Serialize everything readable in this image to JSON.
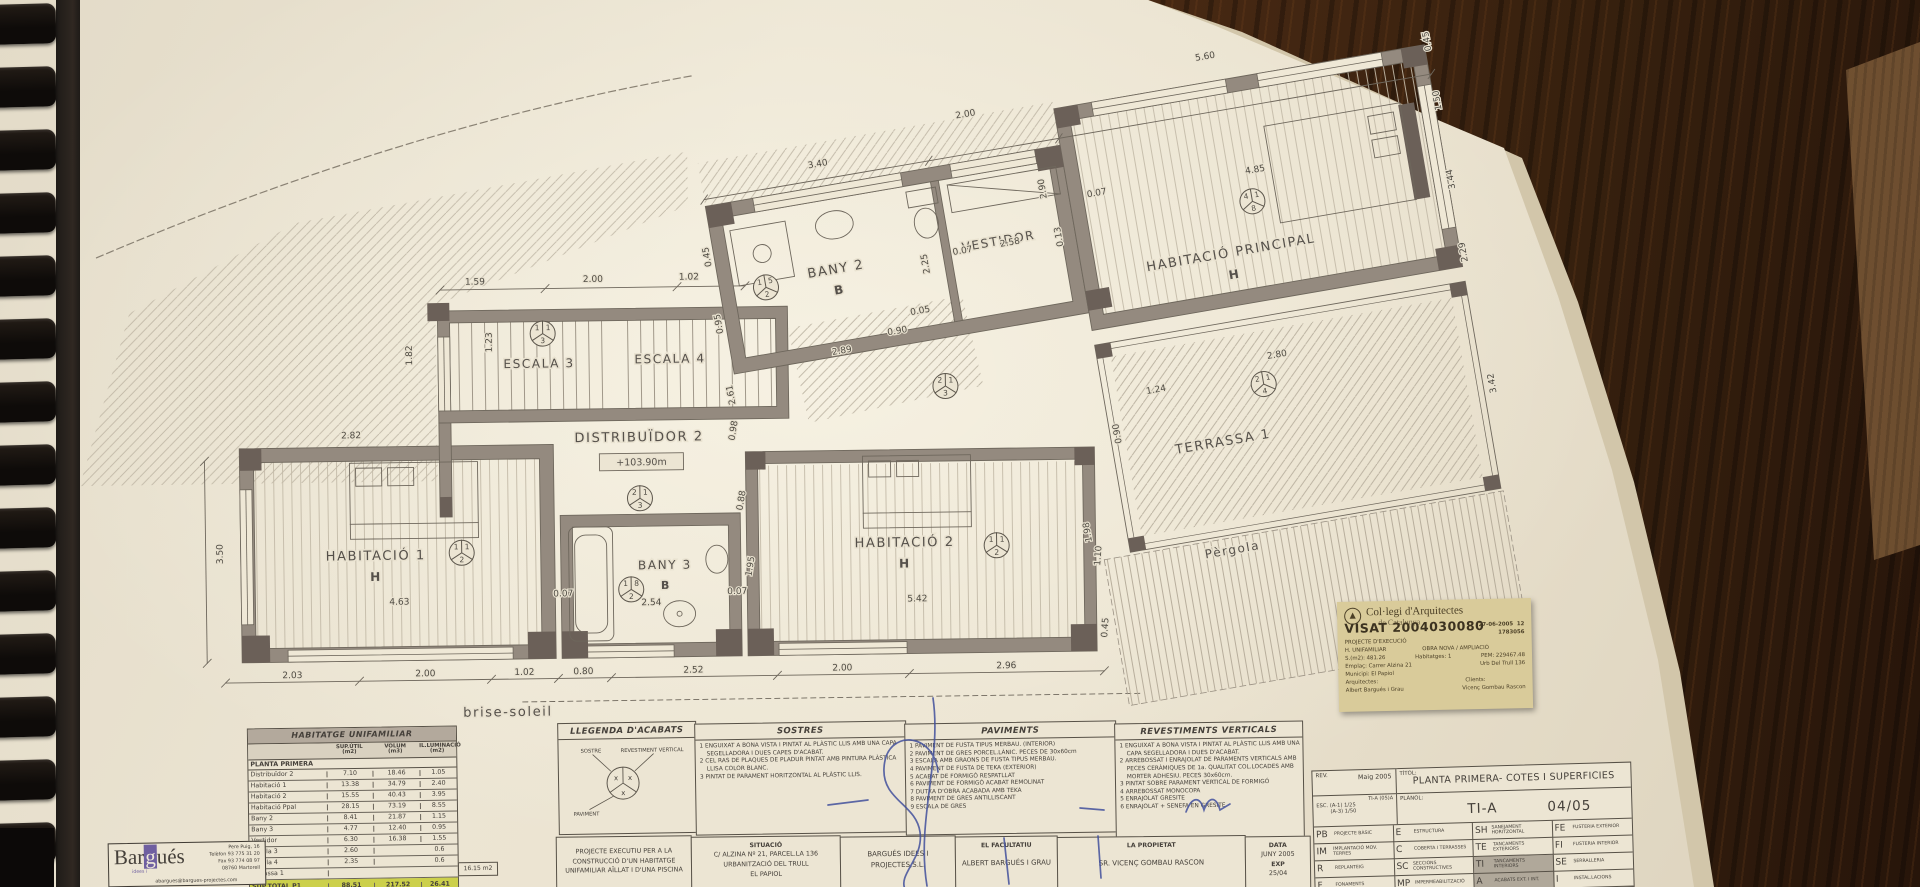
{
  "plan": {
    "labels": [
      [
        "HABITACIÓ 1",
        375,
        556,
        13,
        "s",
        0
      ],
      [
        "H",
        375,
        577,
        12,
        "s",
        1
      ],
      [
        "BANY 3",
        664,
        569,
        12,
        "s",
        0
      ],
      [
        "B",
        664,
        589,
        11,
        "s",
        1
      ],
      [
        "HABITACIÓ 2",
        904,
        550,
        13,
        "s",
        0
      ],
      [
        "H",
        904,
        571,
        12,
        "s",
        1
      ],
      [
        "ESCALA 3",
        541,
        366,
        12,
        "s",
        0
      ],
      [
        "ESCALA 4",
        672,
        363,
        12,
        "s",
        0
      ],
      [
        "DISTRIBUÏDOR 2",
        640,
        441,
        13,
        "s",
        0
      ],
      [
        "+103.90m",
        642,
        465,
        9.5,
        "s",
        0
      ],
      [
        "brise-soleil",
        505,
        714,
        13,
        "s",
        0
      ],
      [
        "BANY 2",
        870,
        300,
        13,
        "u",
        0
      ],
      [
        "B",
        870,
        321,
        12,
        "u",
        1
      ],
      [
        "VESTIDOR",
        1035,
        300,
        12,
        "u",
        0
      ],
      [
        "HABITACIÓ PRINCIPAL",
        1262,
        351,
        13,
        "u",
        0
      ],
      [
        "H",
        1262,
        373,
        12,
        "u",
        1
      ],
      [
        "TERRASSA 1",
        1222,
        536,
        13,
        "u",
        0
      ],
      [
        "Pèrgola",
        1213,
        644,
        12,
        "u",
        0
      ]
    ],
    "dims": [
      [
        "2.03",
        290,
        673,
        0,
        "s"
      ],
      [
        "2.00",
        423,
        673,
        0,
        "s"
      ],
      [
        "1.02",
        522,
        673,
        0,
        "s"
      ],
      [
        "0.80",
        581,
        673,
        0,
        "s"
      ],
      [
        "2.52",
        691,
        673,
        0,
        "s"
      ],
      [
        "2.00",
        840,
        673,
        0,
        "s"
      ],
      [
        "2.96",
        1004,
        673,
        0,
        "s"
      ],
      [
        "4.63",
        398,
        601,
        0,
        "s"
      ],
      [
        "0.07",
        562,
        595,
        0,
        "s"
      ],
      [
        "2.54",
        650,
        605,
        0,
        "s"
      ],
      [
        "0.07",
        736,
        595,
        0,
        "s"
      ],
      [
        "5.42",
        916,
        605,
        0,
        "s"
      ],
      [
        "3.50",
        222,
        548,
        -90,
        "s"
      ],
      [
        "2.82",
        352,
        434,
        0,
        "s"
      ],
      [
        "1.82",
        414,
        352,
        -90,
        "s"
      ],
      [
        "1.23",
        494,
        340,
        -90,
        "s"
      ],
      [
        "1.59",
        478,
        282,
        0,
        "s"
      ],
      [
        "2.00",
        596,
        281,
        0,
        "s"
      ],
      [
        "1.02",
        692,
        280,
        0,
        "s"
      ],
      [
        "0.98",
        737,
        432,
        -80,
        "s"
      ],
      [
        "0.88",
        744,
        502,
        -80,
        "s"
      ],
      [
        "1.95",
        752,
        568,
        -80,
        "s"
      ],
      [
        "1.10",
        1100,
        562,
        -85,
        "s"
      ],
      [
        "0.45",
        1106,
        634,
        -85,
        "s"
      ],
      [
        "3.40",
        870,
        192,
        0,
        "u"
      ],
      [
        "2.00",
        1024,
        168,
        0,
        "u"
      ],
      [
        "5.60",
        1270,
        152,
        0,
        "u"
      ],
      [
        "0.45",
        748,
        262,
        -90,
        "u"
      ],
      [
        "0.95",
        748,
        330,
        -90,
        "u"
      ],
      [
        "2.61",
        748,
        402,
        -90,
        "u"
      ],
      [
        "2.89",
        862,
        380,
        0,
        "u"
      ],
      [
        "0.90",
        920,
        370,
        0,
        "u"
      ],
      [
        "0.05",
        946,
        354,
        0,
        "u"
      ],
      [
        "2.25",
        962,
        306,
        -90,
        "u"
      ],
      [
        "0.07",
        998,
        302,
        0,
        "u"
      ],
      [
        "2.58",
        1046,
        302,
        0,
        "u"
      ],
      [
        "0.13",
        1098,
        302,
        -90,
        "u"
      ],
      [
        "2.90",
        1090,
        252,
        -90,
        "u"
      ],
      [
        "4.85",
        1300,
        272,
        0,
        "u"
      ],
      [
        "0.07",
        1140,
        268,
        0,
        "u"
      ],
      [
        "0.45",
        1494,
        172,
        -90,
        "u"
      ],
      [
        "1.50",
        1494,
        232,
        -90,
        "u"
      ],
      [
        "3.44",
        1494,
        312,
        -90,
        "u"
      ],
      [
        "2.29",
        1494,
        386,
        -90,
        "u"
      ],
      [
        "2.80",
        1290,
        458,
        0,
        "u"
      ],
      [
        "1.24",
        1165,
        472,
        0,
        "u"
      ],
      [
        "0.90",
        1122,
        506,
        -90,
        "u"
      ],
      [
        "1.98",
        1076,
        598,
        -90,
        "u"
      ],
      [
        "3.42",
        1500,
        520,
        -90,
        "u"
      ]
    ],
    "circles": [
      [
        545,
        332,
        "1",
        "1",
        "3",
        "s"
      ],
      [
        630,
        589,
        "1",
        "8",
        "2",
        "s"
      ],
      [
        996,
        550,
        "1",
        "1",
        "2",
        "s"
      ],
      [
        461,
        550,
        "1",
        "1",
        "2",
        "s"
      ],
      [
        640,
        498,
        "2",
        "1",
        "3",
        "s"
      ],
      [
        947,
        390,
        "2",
        "1",
        "3",
        "s"
      ],
      [
        798,
        302,
        "1",
        "5",
        "2",
        "u"
      ],
      [
        1292,
        300,
        "4",
        "1",
        "8",
        "u"
      ],
      [
        1272,
        482,
        "2",
        "1",
        "4",
        "u"
      ]
    ]
  },
  "area_table": {
    "title": "HABITATGE UNIFAMILIAR",
    "col_headers": [
      "SUP.ÚTIL",
      "VOLUM",
      "IL.LUMINACIÓ"
    ],
    "col_units": [
      "(m2)",
      "(m3)",
      "(m2)"
    ],
    "section": "PLANTA PRIMERA",
    "rows": [
      [
        "Distribuïdor 2",
        "7.10",
        "18.46",
        "1.05"
      ],
      [
        "Habitació 1",
        "13.38",
        "34.79",
        "2.40"
      ],
      [
        "Habitació 2",
        "15.55",
        "40.43",
        "3.95"
      ],
      [
        "Habitació Ppal",
        "28.15",
        "73.19",
        "8.55"
      ],
      [
        "Bany 2",
        "8.41",
        "21.87",
        "1.15"
      ],
      [
        "Bany 3",
        "4.77",
        "12.40",
        "0.95"
      ],
      [
        "Vestidor",
        "6.30",
        "16.38",
        "1.55"
      ],
      [
        "Escala 3",
        "2.60",
        "",
        "0.6"
      ],
      [
        "Escala 4",
        "2.35",
        "",
        "0.6"
      ],
      [
        "Terrassa 1",
        "",
        "",
        ""
      ]
    ],
    "total_row": [
      "SUP.TOTAL P1",
      "88.51",
      "217.52",
      "26.41"
    ],
    "side_note": "16.15 m2"
  },
  "legend": {
    "legenda_title": "LLEGENDA D'ACABATS",
    "symbol_labels": {
      "sostre": "SOSTRE",
      "revestiment": "REVESTIMENT VERTICAL",
      "paviment": "PAVIMENT"
    },
    "sostres_title": "SOSTRES",
    "sostres_items": [
      "1 ENGUIXAT A BONA VISTA I PINTAT AL PLÀSTIC LLIS AMB UNA CAPA SEGELLADORA I DUES CAPES D'ACABAT.",
      "2 CEL RAS DE PLAQUES DE PLADUR PINTAT AMB PINTURA PLÀSTICA LLISA COLOR BLANC.",
      "3 PINTAT DE PARAMENT HORITZONTAL AL PLÀSTIC LLIS."
    ],
    "paviments_title": "PAVIMENTS",
    "paviments_items": [
      "1 PAVIMENT DE FUSTA TIPUS MERBAU. (INTERIOR)",
      "2 PAVIMENT DE GRES PORCEL.LÀNIC. PECES DE 30x60cm",
      "3 ESCALA AMB GRAONS DE FUSTA TIPUS MERBAU.",
      "4 PAVIMENT DE FUSTA DE TEKA (EXTERIOR)",
      "5 ACABAT DE FORMIGÓ RESPATLLAT",
      "6 PAVIMENT DE FORMIGÓ ACABAT REMOLINAT",
      "7 DUTXA D'OBRA ACABADA AMB TEKA",
      "8 PAVIMENT DE GRES ANTILLISCANT",
      "9 ESCALA DE GRES"
    ],
    "revestiments_title": "REVESTIMENTS VERTICALS",
    "revestiments_items": [
      "1 ENGUIXAT A BONA VISTA I PINTAT AL PLÀSTIC LLIS AMB UNA CAPA SEGELLADORA I DUES D'ACABAT.",
      "2 ARREBOSSAT I ENRAJOLAT DE PARAMENTS VERTICALS AMB PECES CERÀMIQUES DE 1a. QUALITAT COL.LOCADES AMB MORTER ADHESIU. PECES 30x60cm.",
      "3 PINTAT SOBRE PARAMENT VERTICAL DE FORMIGÓ",
      "4 ARREBOSSAT MONOCOPA",
      "5 ENRAJOLAT GRESITE",
      "6 ENRAJOLAT + SENEFA EN GRESITE"
    ]
  },
  "title_strip": {
    "project_lines": [
      "PROJEC­TE EXECUTIU PER A LA",
      "CONSTRUCCIÓ D'UN HABITATGE",
      "UNIFAMILIAR AÏLLAT I D'UNA PISCINA"
    ],
    "situacio_title": "SITUACIÓ",
    "situacio_lines": [
      "C/ ALZINA Nº 21, PARCEL.LA 136",
      "URBANITZACIÓ DEL TRULL",
      "EL PAPIOL"
    ],
    "company": "BARGUÉS IDEES I PROJECTES,S.L.",
    "facultatiu_title": "EL FACULTATIU",
    "facultatiu_name": "ALBERT BARGUÉS I GRAU",
    "propietat_title": "LA PROPIETAT",
    "propietat_name": "SR. VICENÇ GOMBAU RASCON",
    "data_title": "DATA",
    "data_value": "JUNY 2005",
    "exp_title": "EXP",
    "exp_value": "25/04"
  },
  "rev_table": {
    "rev_label": "REV.",
    "rev_value": "Maig 2005",
    "titol_label": "TÍTOL:",
    "titol": "PLANTA PRIMERA- COTES I SUPERFICIES",
    "code_small": "TI-A (05)A",
    "esc_label": "ESC.",
    "esc1": "(A-1)  1/25",
    "esc2": "(A-3)  1/50",
    "planol_label": "PLÀNOL:",
    "sheet_code": "TI-A",
    "sheet_num": "04/05",
    "codes": [
      {
        "c": "PB",
        "l": "PROJECTE BÀSIC",
        "hl": false
      },
      {
        "c": "E",
        "l": "ESTRUCTURA",
        "hl": false
      },
      {
        "c": "SH",
        "l": "SANEJAMENT HORITZONTAL",
        "hl": false
      },
      {
        "c": "FE",
        "l": "FUSTERIA EXTERIOR",
        "hl": false
      },
      {
        "c": "IM",
        "l": "IMPLANTACIÓ MOV. TERRES",
        "hl": false
      },
      {
        "c": "C",
        "l": "COBERTA I TERRASSES",
        "hl": false
      },
      {
        "c": "TE",
        "l": "TANCAMENTS EXTERIORS",
        "hl": false
      },
      {
        "c": "FI",
        "l": "FUSTERIA INTERIOR",
        "hl": false
      },
      {
        "c": "R",
        "l": "REPLANTEIG",
        "hl": false
      },
      {
        "c": "SC",
        "l": "SECCIONS CONSTRUCTIVES",
        "hl": false
      },
      {
        "c": "TI",
        "l": "TANCAMENTS INTERIORS",
        "hl": true
      },
      {
        "c": "SE",
        "l": "SERRALLERIA",
        "hl": false
      },
      {
        "c": "F",
        "l": "FONAMENTS",
        "hl": false
      },
      {
        "c": "MP",
        "l": "IMPERMEABILITZACIÓ",
        "hl": false
      },
      {
        "c": "A",
        "l": "ACABATS EXT. I INT.",
        "hl": true
      },
      {
        "c": "I",
        "l": "INSTAL.LACIONS",
        "hl": false
      }
    ]
  },
  "stamp": {
    "org": "Col·legi d'Arquitectes",
    "org2": "de Catalunya",
    "visat": "VISAT 2004030080",
    "date": "27-06-2005",
    "num": "12",
    "reg": "1783056",
    "line1": "PROJECTE D'EXECUCIÓ",
    "l2a": "H. UNIFAMILIAR",
    "l2b": "OBRA NOVA / AMPLIACIÓ",
    "l3a": "S.(m2): 481.26",
    "l3b": "Habitatges: 1",
    "l3c": "PEM: 229467.48",
    "l4a": "Emplaç: Carrer Alzina 21",
    "l4b": "Urb Del Trull 136",
    "l5": "Municipi: El Papiol",
    "l6a": "Arquitectes:",
    "l6b": "Clients:",
    "l7a": "Albert Bargués i Grau",
    "l7b": "Vicenç Gombau Rascon"
  },
  "firm": {
    "name_a": "Bar",
    "name_g": "g",
    "name_b": "ués",
    "tagline": "idees i",
    "addr_lines": [
      "Pere Puig, 16",
      "Telèfon 93 775 31 20",
      "Fax 93 774 08 97",
      "08760  Martorell"
    ],
    "email": "abargues@bargues-projectes.com"
  }
}
